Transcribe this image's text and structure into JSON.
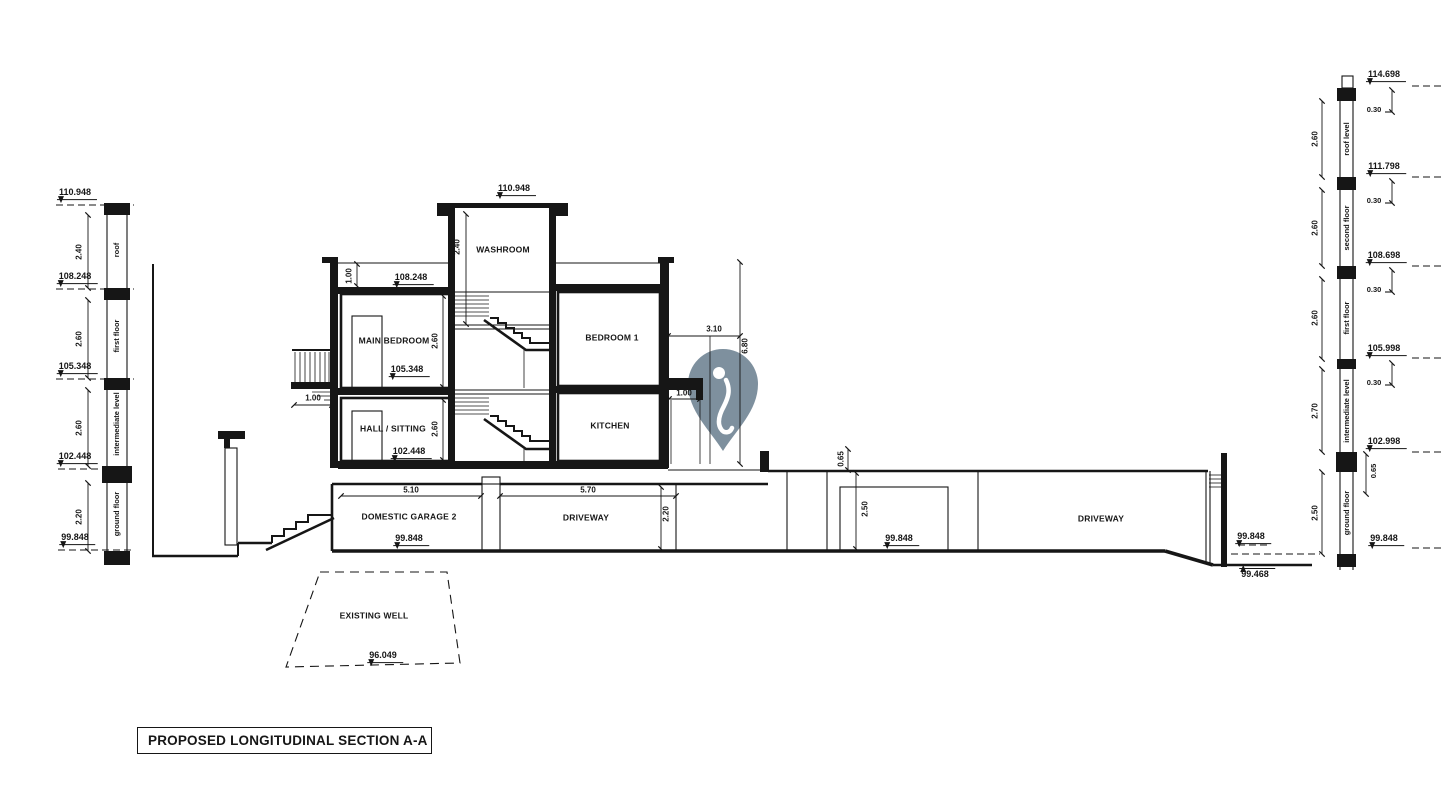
{
  "title_block": {
    "title": "PROPOSED LONGITUDINAL SECTION A-A"
  },
  "colors": {
    "pin": "#7E909E",
    "line": "#161616"
  },
  "left_scale": {
    "levels": [
      "110.948",
      "108.248",
      "105.348",
      "102.448",
      "99.848"
    ],
    "heights": [
      "2.40",
      "2.60",
      "2.60",
      "2.20"
    ],
    "floors": [
      "roof",
      "first floor",
      "intermediate level",
      "ground floor"
    ]
  },
  "right_scale": {
    "levels": [
      "114.698",
      "111.798",
      "108.698",
      "105.998",
      "102.998",
      "99.848"
    ],
    "heights": [
      "2.60",
      "2.60",
      "2.60",
      "2.70",
      "2.50"
    ],
    "floors": [
      "roof level",
      "second floor",
      "first floor",
      "intermediate level",
      "ground floor"
    ],
    "offsets": [
      "0.30",
      "0.30",
      "0.30",
      "0.30",
      "0.65"
    ]
  },
  "section": {
    "levels": {
      "tower_top": "110.948",
      "roof": "108.248",
      "first": "105.348",
      "intermediate": "102.448",
      "garage": "99.848",
      "driveway": "99.848",
      "right_ground": "99.848",
      "right_road": "99.468",
      "well_bottom": "96.049"
    },
    "rooms": {
      "washroom": "WASHROOM",
      "main_bedroom": "MAIN BEDROOM",
      "hall_sitting": "HALL / SITTING",
      "bedroom1": "BEDROOM 1",
      "kitchen": "KITCHEN",
      "garage": "DOMESTIC GARAGE 2",
      "driveway_left": "DRIVEWAY",
      "driveway_right": "DRIVEWAY",
      "well": "EXISTING WELL"
    },
    "dims": {
      "washroom_h": "2.40",
      "parapet": "1.00",
      "bedroom_h": "2.60",
      "hall_h": "2.60",
      "balcony_w": "1.00",
      "offset_310": "3.10",
      "height_680": "6.80",
      "kitchen_stub": "1.00",
      "garage_w": "5.10",
      "driveway_w": "5.70",
      "driveway_h": "2.20",
      "kerb": "0.65",
      "door_h": "2.50"
    }
  }
}
